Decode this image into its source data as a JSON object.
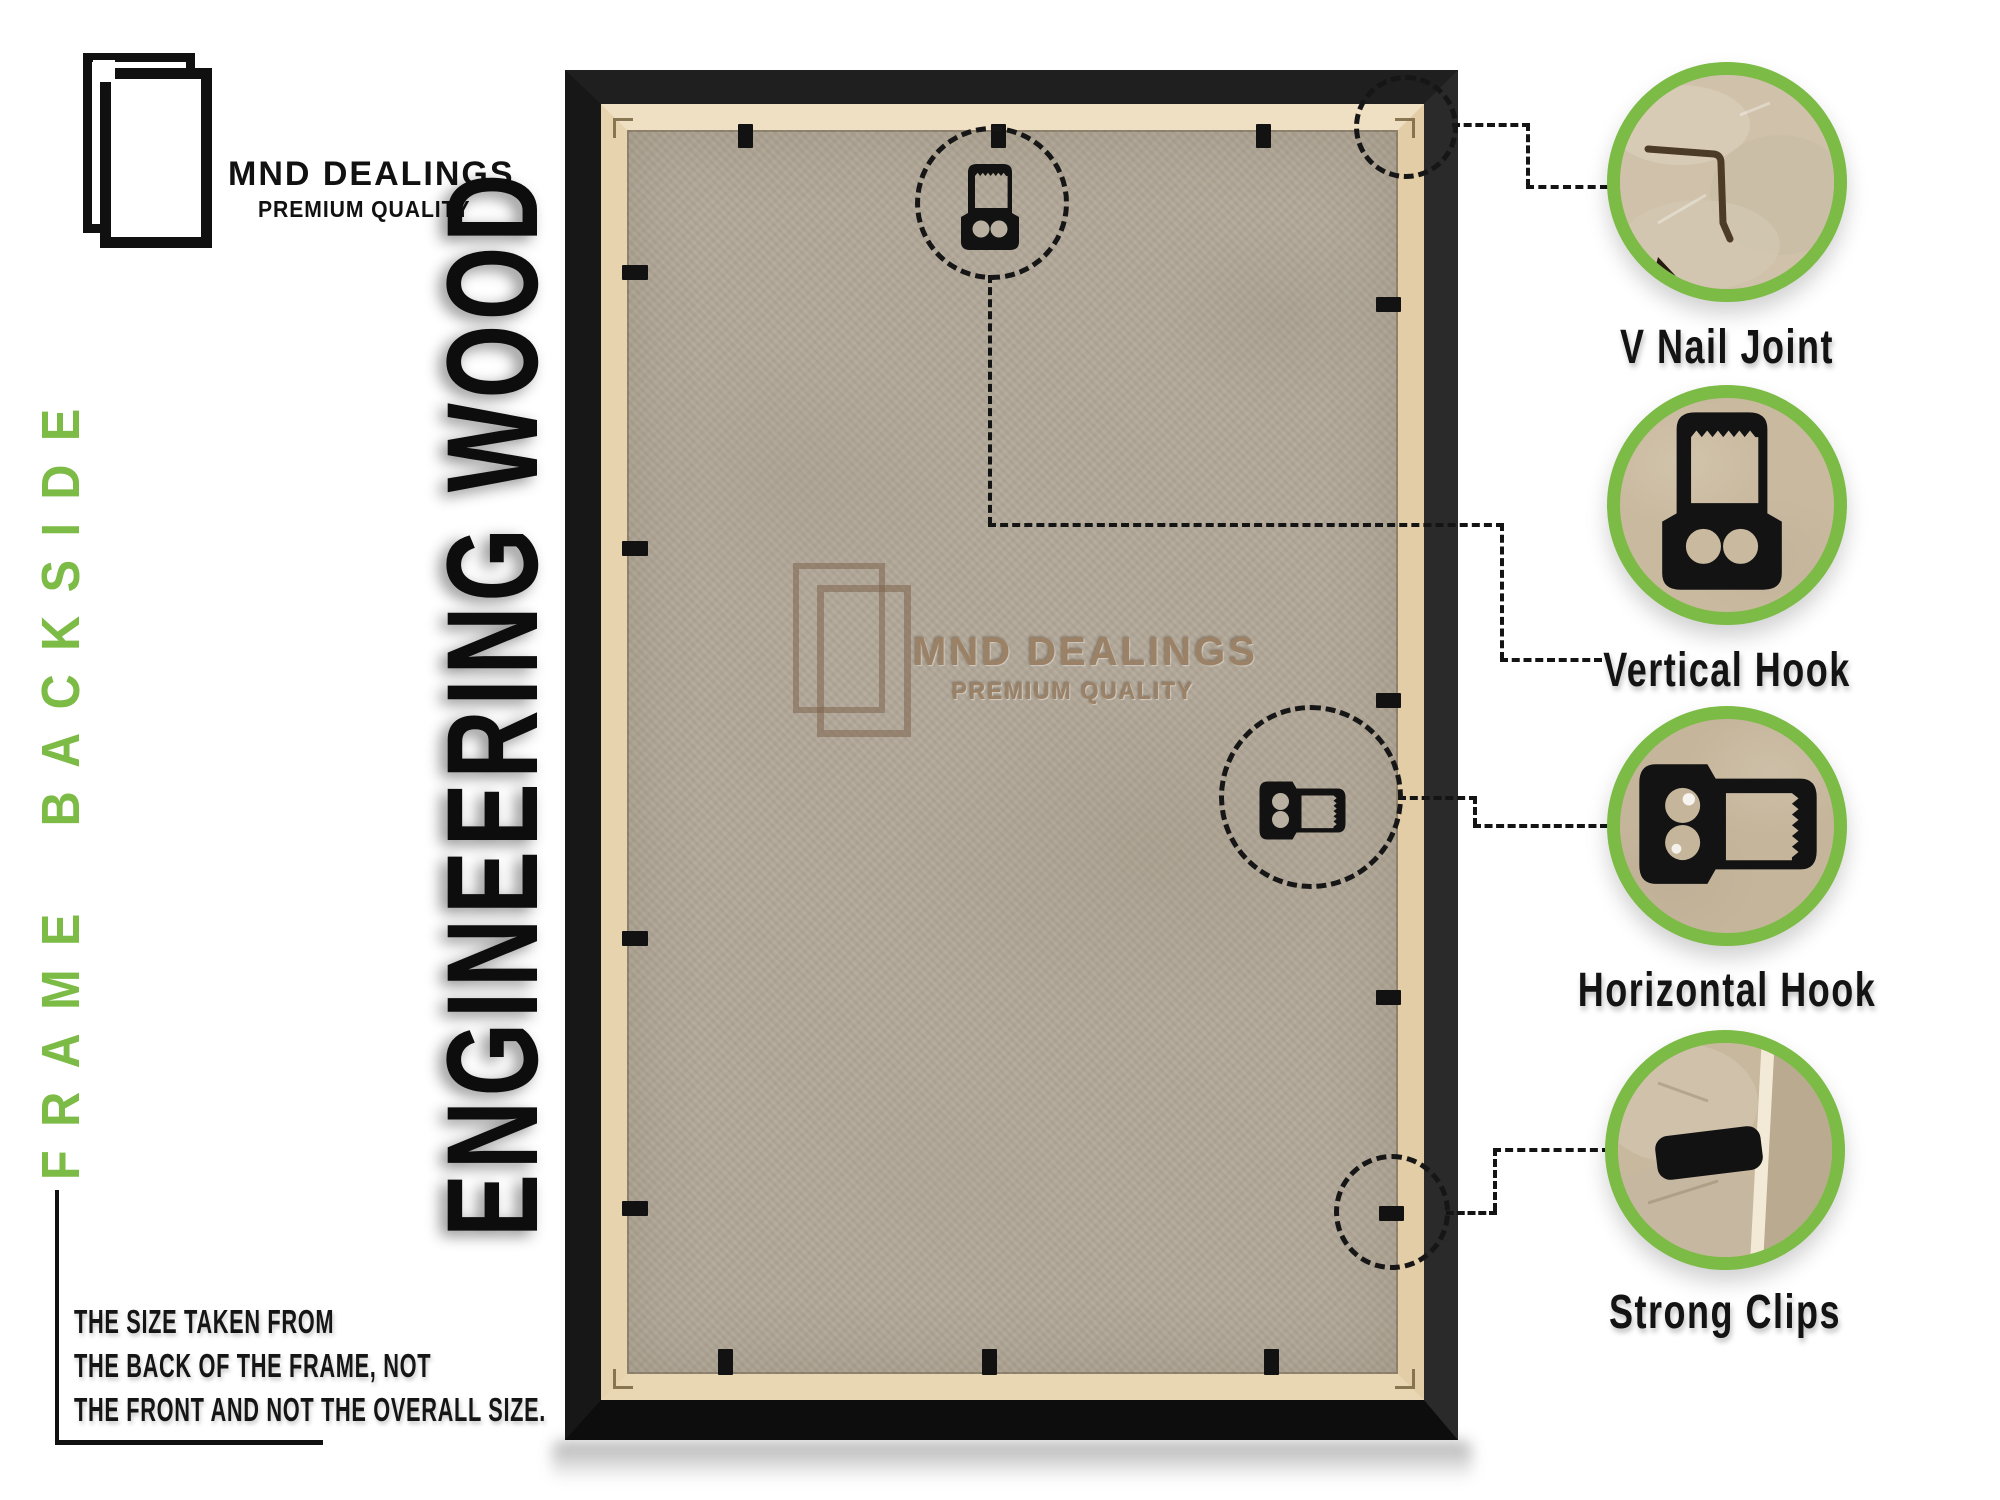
{
  "brand": {
    "name": "MND DEALINGS",
    "tagline": "PREMIUM QUALITY"
  },
  "side_label": "FRAME BACKSIDE",
  "material_label": "ENGINEERING WOOD",
  "note": {
    "line1": "THE SIZE TAKEN FROM",
    "line2": "THE BACK OF THE FRAME, NOT",
    "line3": "THE FRONT AND NOT THE OVERALL SIZE."
  },
  "watermark": {
    "name": "MND DEALINGS",
    "tagline": "PREMIUM QUALITY"
  },
  "callouts": [
    {
      "id": "v-nail-joint",
      "label": "V Nail Joint"
    },
    {
      "id": "vertical-hook",
      "label": "Vertical Hook"
    },
    {
      "id": "horizontal-hook",
      "label": "Horizontal Hook"
    },
    {
      "id": "strong-clips",
      "label": "Strong Clips"
    }
  ],
  "colors": {
    "accent_green": "#7cbb45",
    "frame_black": "#161616",
    "mdf_board": "#b2a899",
    "wood_strip": "#e7d3ae",
    "watermark_brown": "#9b8266",
    "label_text": "#131313"
  }
}
